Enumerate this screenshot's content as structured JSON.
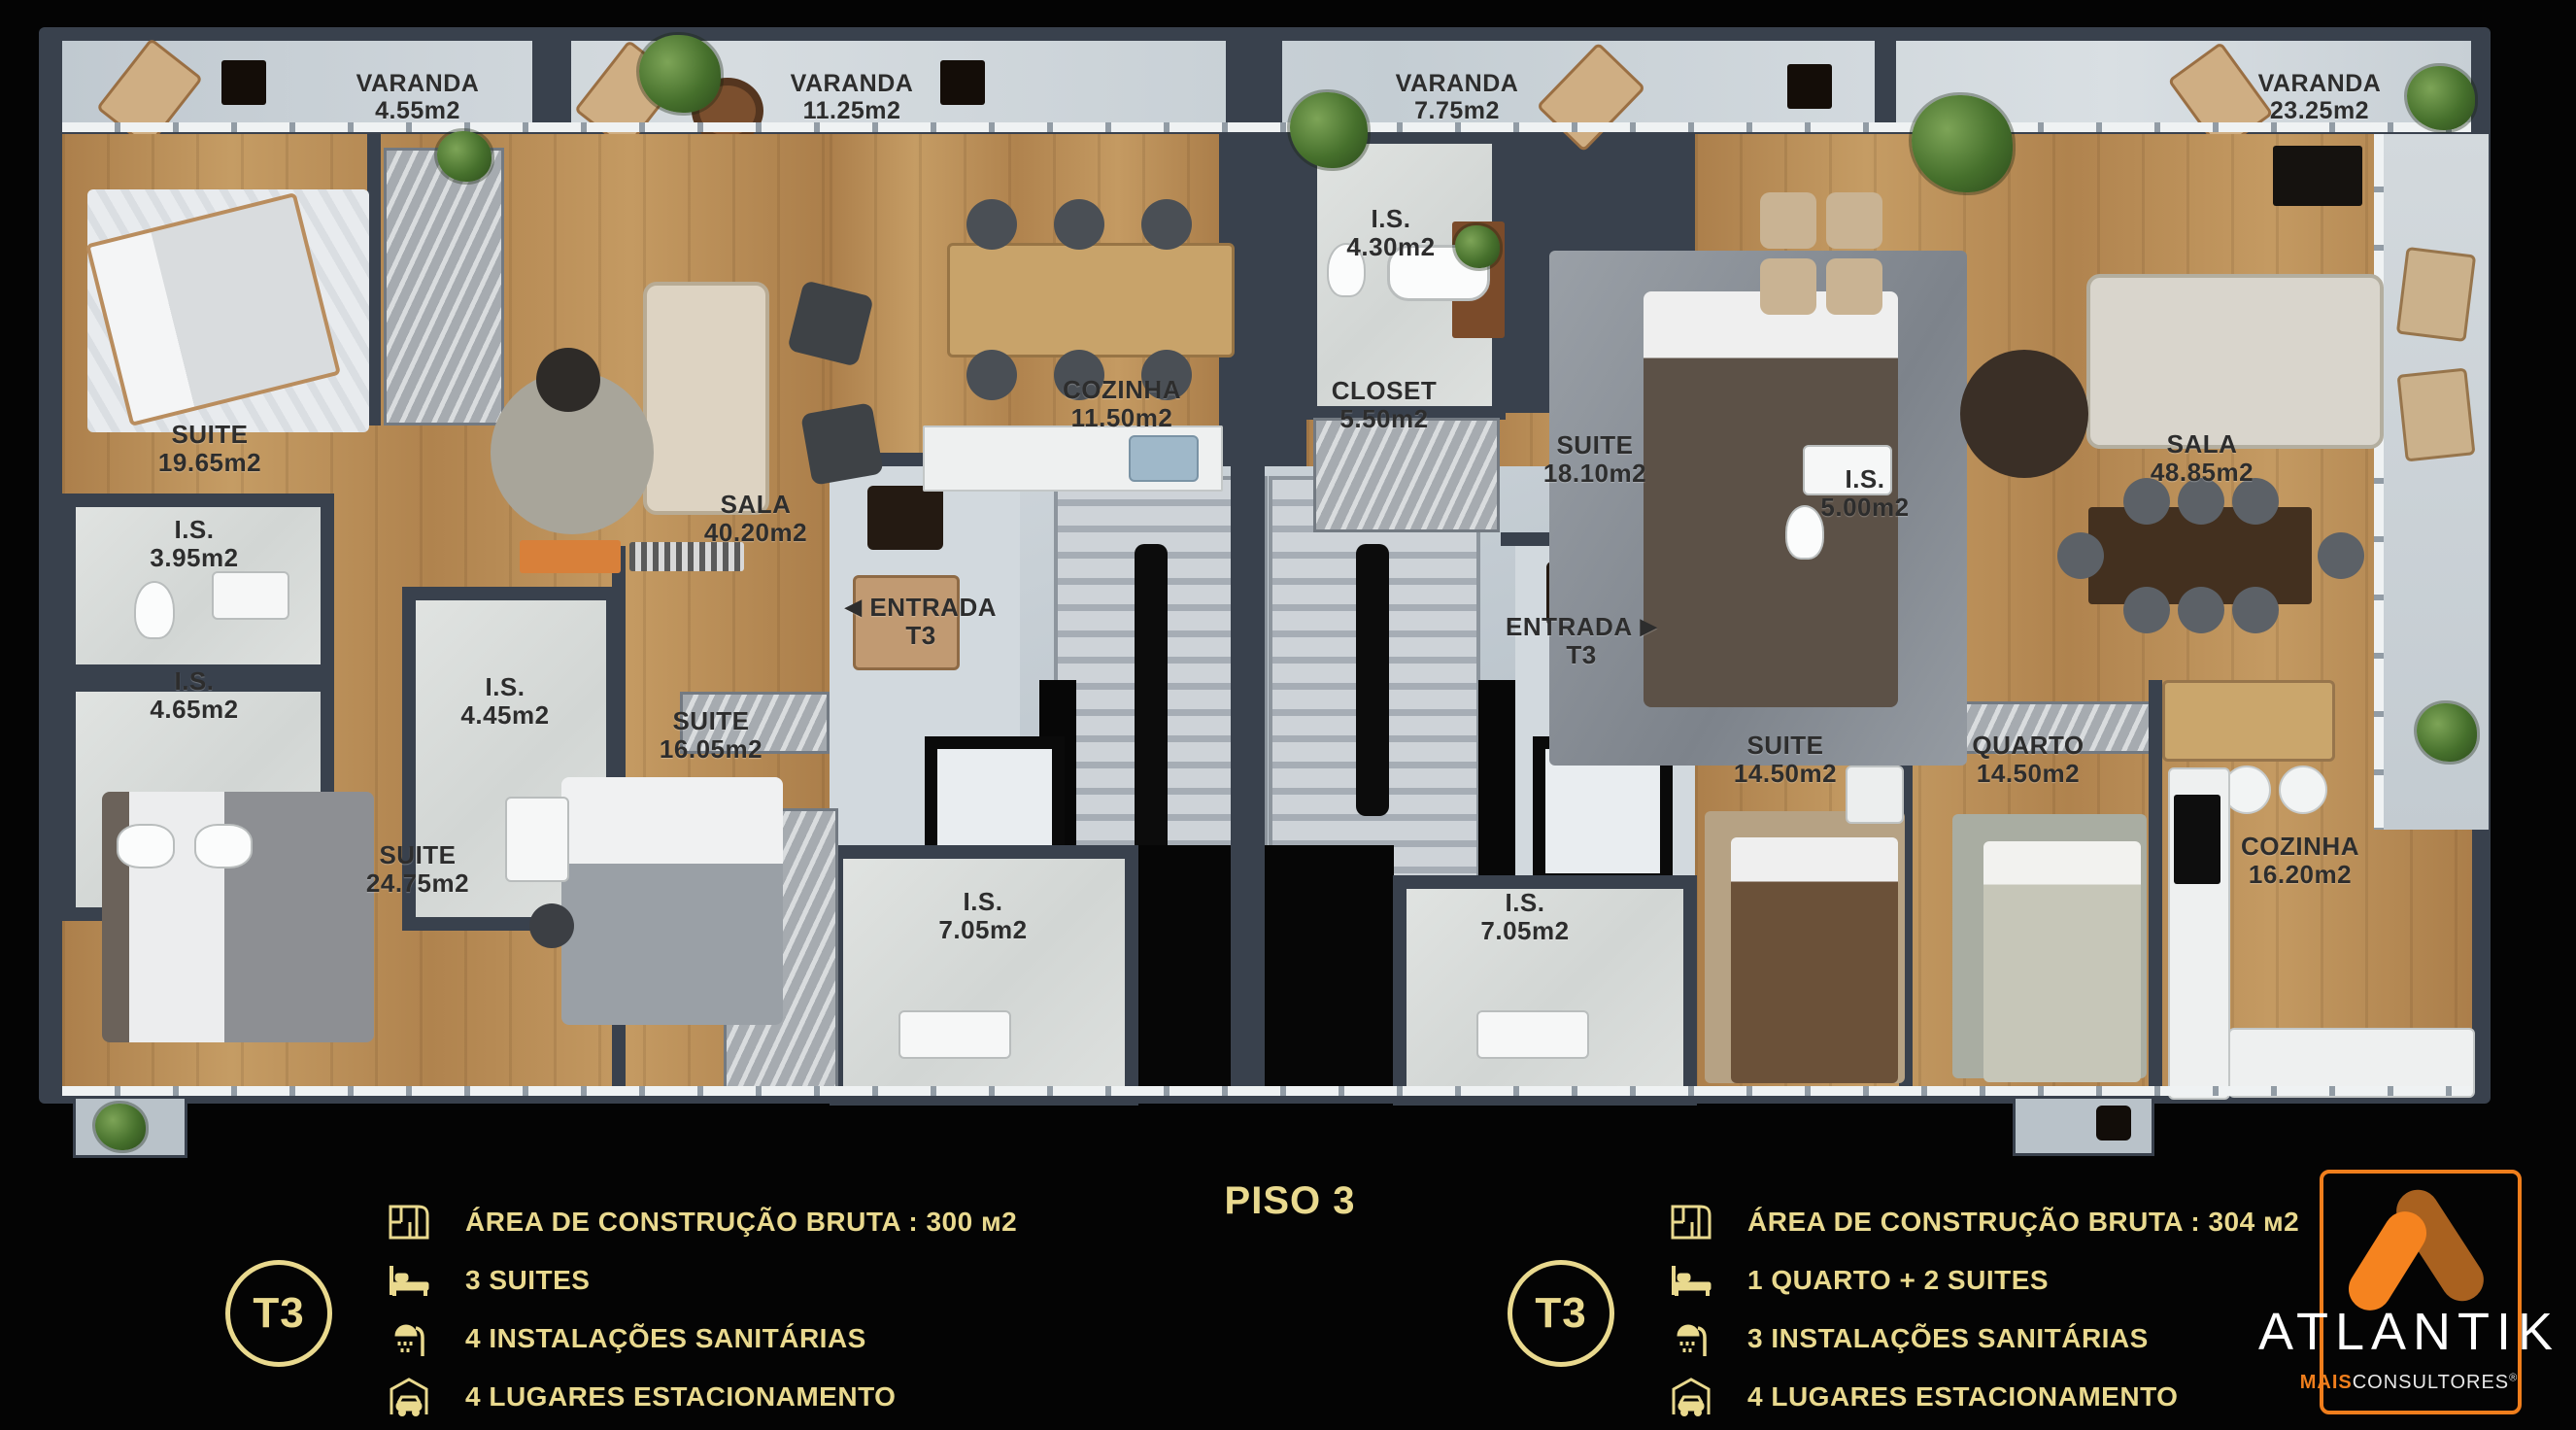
{
  "title": "PISO 3",
  "varandas": [
    {
      "name": "VARANDA",
      "area": "4.55m2"
    },
    {
      "name": "VARANDA",
      "area": "11.25m2"
    },
    {
      "name": "VARANDA",
      "area": "7.75m2"
    },
    {
      "name": "VARANDA",
      "area": "23.25m2"
    }
  ],
  "left_unit": {
    "rooms": {
      "suite_a": {
        "name": "SUITE",
        "area": "19.65m2"
      },
      "is_a": {
        "name": "I.S.",
        "area": "3.95m2"
      },
      "is_b": {
        "name": "I.S.",
        "area": "4.65m2"
      },
      "is_c": {
        "name": "I.S.",
        "area": "4.45m2"
      },
      "suite_b": {
        "name": "SUITE",
        "area": "24.75m2"
      },
      "suite_c": {
        "name": "SUITE",
        "area": "16.05m2"
      },
      "sala": {
        "name": "SALA",
        "area": "40.20m2"
      },
      "cozinha": {
        "name": "COZINHA",
        "area": "11.50m2"
      },
      "entrada": {
        "name": "ENTRADA",
        "area": "T3",
        "arrow": "◀"
      },
      "is_d": {
        "name": "I.S.",
        "area": "7.05m2"
      }
    },
    "legend": {
      "badge": "T3",
      "items": [
        {
          "icon": "floor-plan-icon",
          "text": "ÁREA DE CONSTRUÇÃO BRUTA :  300 м2"
        },
        {
          "icon": "bed-icon",
          "text": "3 SUITES"
        },
        {
          "icon": "shower-icon",
          "text": "4 INSTALAÇÕES SANITÁRIAS"
        },
        {
          "icon": "garage-icon",
          "text": "4 LUGARES ESTACIONAMENTO"
        }
      ]
    }
  },
  "right_unit": {
    "rooms": {
      "is_a": {
        "name": "I.S.",
        "area": "4.30m2"
      },
      "closet": {
        "name": "CLOSET",
        "area": "5.50m2"
      },
      "suite_a": {
        "name": "SUITE",
        "area": "18.10m2"
      },
      "is_b": {
        "name": "I.S.",
        "area": "5.00m2"
      },
      "sala": {
        "name": "SALA",
        "area": "48.85m2"
      },
      "entrada": {
        "name": "ENTRADA",
        "area": "T3",
        "arrow": "▶"
      },
      "is_c": {
        "name": "I.S.",
        "area": "7.05m2"
      },
      "suite_b": {
        "name": "SUITE",
        "area": "14.50m2"
      },
      "quarto": {
        "name": "QUARTO",
        "area": "14.50m2"
      },
      "cozinha": {
        "name": "COZINHA",
        "area": "16.20m2"
      }
    },
    "legend": {
      "badge": "T3",
      "items": [
        {
          "icon": "floor-plan-icon",
          "text": "ÁREA DE CONSTRUÇÃO BRUTA :  304 м2"
        },
        {
          "icon": "bed-icon",
          "text": "1 QUARTO + 2 SUITES"
        },
        {
          "icon": "shower-icon",
          "text": "3 INSTALAÇÕES SANITÁRIAS"
        },
        {
          "icon": "garage-icon",
          "text": "4 LUGARES ESTACIONAMENTO"
        }
      ]
    }
  },
  "logo": {
    "brand": "ATLANTIK",
    "sub_accent": "MAIS",
    "sub": "CONSULTORES",
    "registered": "®"
  },
  "colors": {
    "gold": "#e9d98e",
    "orange": "#f5831f",
    "orange_dark": "#a9611f",
    "wood": "#b9905a",
    "wall": "#39414d",
    "tile": "#d8dcda",
    "core_tile": "#c2cbd2",
    "background": "#040404"
  }
}
